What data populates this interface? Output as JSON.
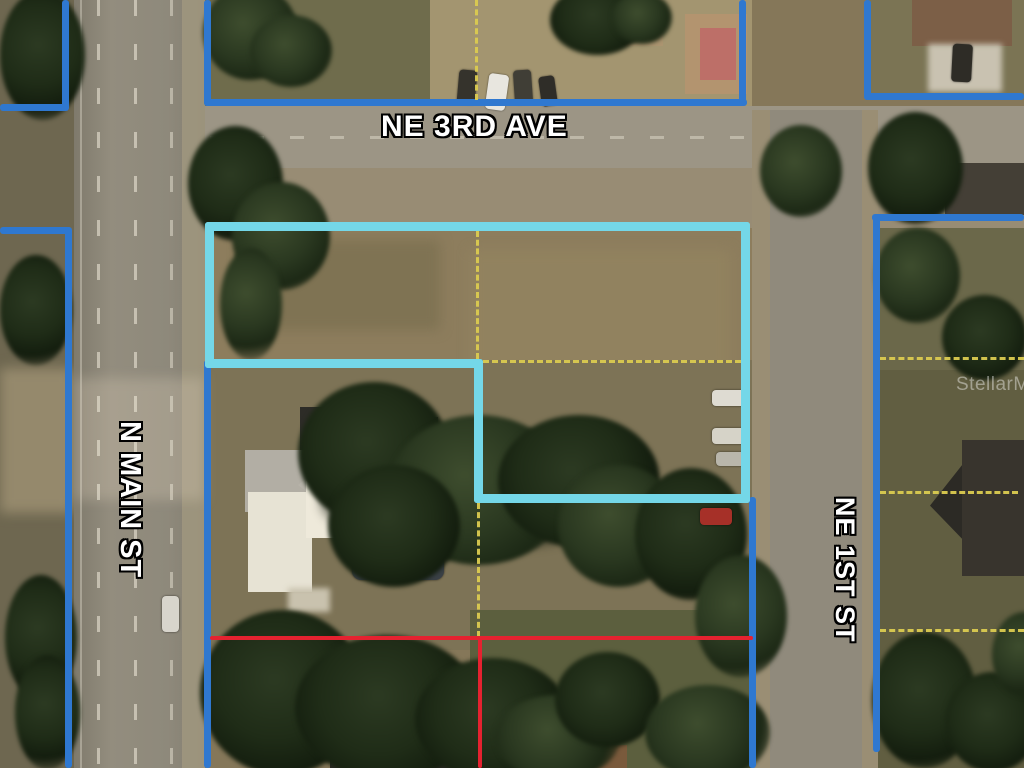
{
  "streets": {
    "ne_3rd_ave": {
      "label": "NE 3RD AVE"
    },
    "n_main_st": {
      "label": "N MAIN ST"
    },
    "ne_1st_st": {
      "label": "NE 1ST ST"
    }
  },
  "watermark": {
    "label": "StellarMLS"
  },
  "overlay": {
    "colors": {
      "neighbor_parcel_blue": "#2F78D0",
      "subject_parcel_cyan": "#74D7E8",
      "lot_split_red": "#E52230",
      "interior_lot_line_yellow": "#DBCB50"
    },
    "line_styles": {
      "blue": "solid",
      "cyan": "solid",
      "red": "solid",
      "yellow": "dashed"
    }
  }
}
